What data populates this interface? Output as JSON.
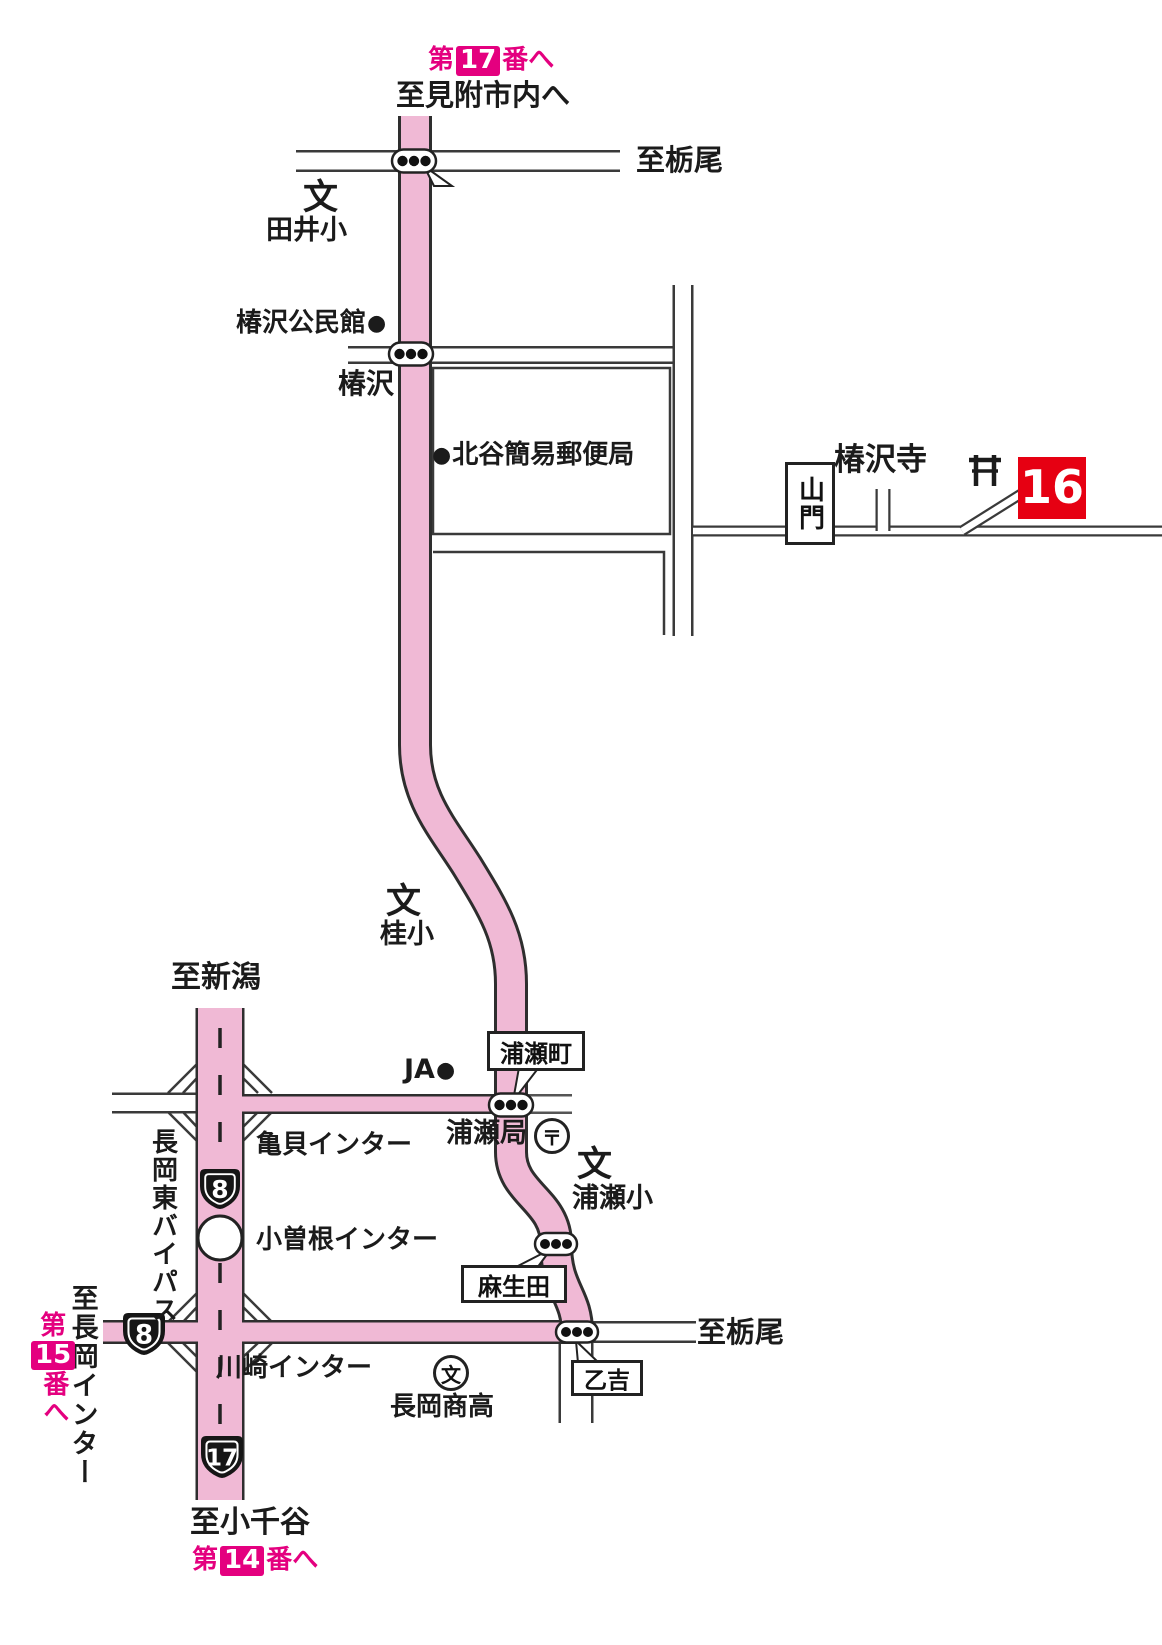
{
  "colors": {
    "route_pink": "#f0b9d5",
    "magenta": "#e4007f",
    "temple_red": "#e60012",
    "road_line": "#3a3a3a"
  },
  "symbols": {
    "bullet": "●",
    "school": "文",
    "post": "〒"
  },
  "header": {
    "to_temple17": {
      "prefix": "第",
      "number": "17",
      "suffix": "番へ"
    },
    "to_mitsuke": "至見附市内へ"
  },
  "destinations": {
    "tochio_north": "至栃尾",
    "tochio_south": "至栃尾",
    "niigata": "至新潟",
    "ojiya": "至小千谷",
    "nagaoka_ic": "至長岡インター"
  },
  "temple_links": {
    "to_temple15": {
      "prefix": "第",
      "number": "15",
      "suffix": "番へ"
    },
    "to_temple14": {
      "prefix": "第",
      "number": "14",
      "suffix": "番へ"
    }
  },
  "signals": {
    "tai": "田井",
    "tsubakizawa": "椿沢",
    "urasemachi": "浦瀬町",
    "asoda": "麻生田",
    "otoyoshi": "乙吉"
  },
  "facilities": {
    "tai_elementary": "田井小",
    "tsubakizawa_community_center": "椿沢公民館",
    "kitadani_post_office": "北谷簡易郵便局",
    "tsubakizawa_temple": "椿沢寺",
    "sanmon_gate": "山門",
    "katsura_elementary": "桂小",
    "ja": "JA",
    "urase_post_office": "浦瀬局",
    "urase_elementary": "浦瀬小",
    "nagaoka_shoko_hs": "長岡商高"
  },
  "roads": {
    "bypass": "長岡東バイパス",
    "kamegai_ic": "亀貝インター",
    "ozone_ic": "小曽根インター",
    "kawasaki_ic": "川崎インター",
    "route8": "8",
    "route17": "17"
  },
  "markers": {
    "temple16_number": "16"
  }
}
